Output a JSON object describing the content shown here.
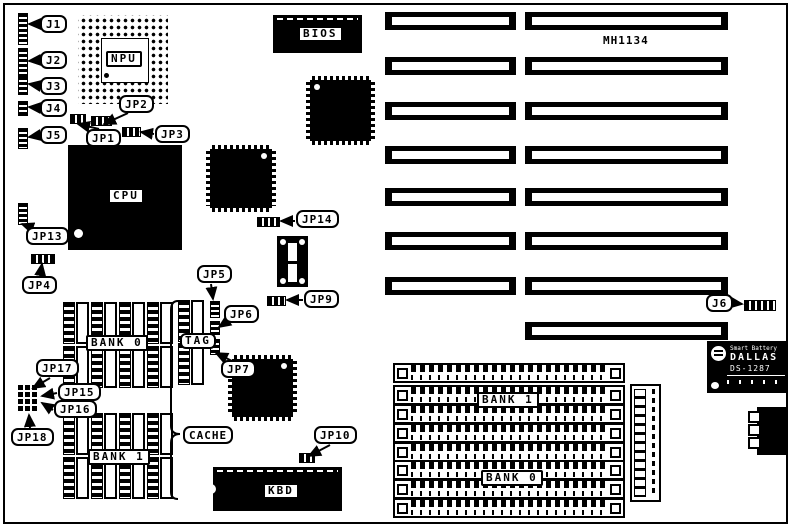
{
  "model": "MH1134",
  "callouts": {
    "j1": "J1",
    "j2": "J2",
    "j3": "J3",
    "j4": "J4",
    "j5": "J5",
    "j6": "J6",
    "jp1": "JP1",
    "jp2": "JP2",
    "jp3": "JP3",
    "jp4": "JP4",
    "jp5": "JP5",
    "jp6": "JP6",
    "jp7": "JP7",
    "jp9": "JP9",
    "jp10": "JP10",
    "jp13": "JP13",
    "jp14": "JP14",
    "jp15": "JP15",
    "jp16": "JP16",
    "jp17": "JP17",
    "jp18": "JP18"
  },
  "chips": {
    "npu": "NPU",
    "cpu": "CPU",
    "bios": "BIOS",
    "kbd": "KBD",
    "tag": "TAG",
    "cache": "CACHE",
    "dip_bank0": "BANK 0",
    "dip_bank1": "BANK 1",
    "simm_bank1": "BANK 1",
    "simm_bank0": "BANK 0"
  },
  "rtc": {
    "line1": "Smart Battery",
    "brand": "DALLAS",
    "part": "DS-1287"
  }
}
